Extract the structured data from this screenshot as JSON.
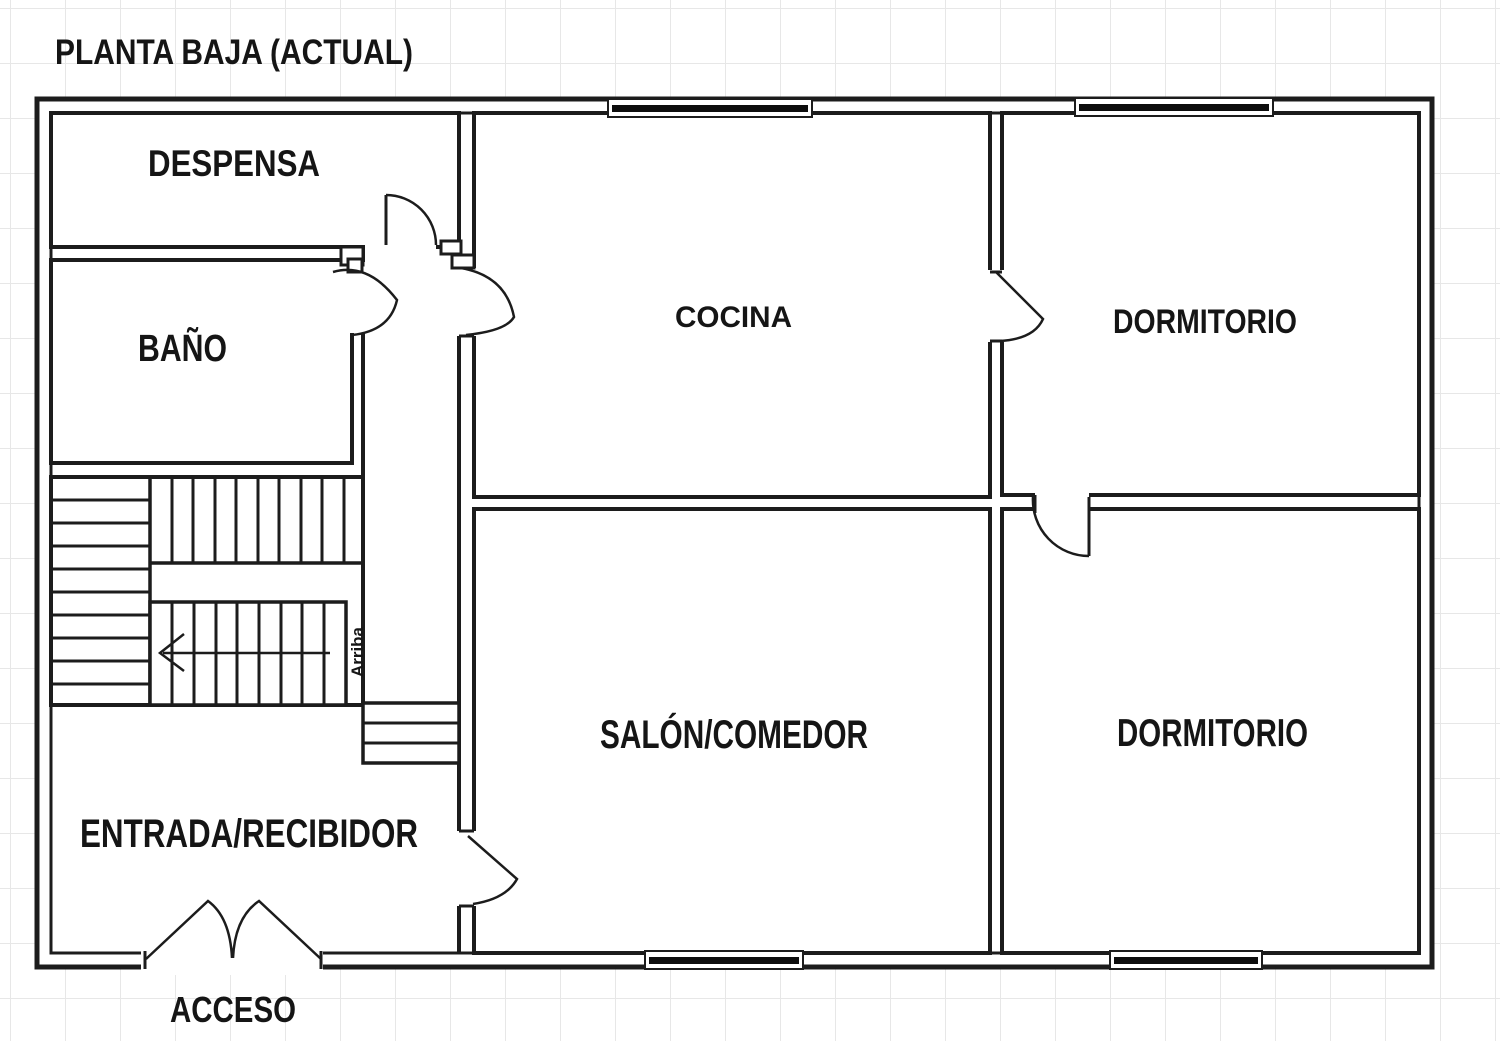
{
  "title": "PLANTA BAJA (ACTUAL)",
  "colors": {
    "wall": "#1c1c1c",
    "grid": "#e7e7e7",
    "window_glass": "#0d0d0d",
    "background": "#ffffff"
  },
  "floor_plan": {
    "rooms": [
      {
        "id": "despensa",
        "label": "DESPENSA"
      },
      {
        "id": "bano",
        "label": "BAÑO"
      },
      {
        "id": "cocina",
        "label": "COCINA"
      },
      {
        "id": "dormitorio_top",
        "label": "DORMITORIO"
      },
      {
        "id": "salon_comedor",
        "label": "SALÓN/COMEDOR"
      },
      {
        "id": "dormitorio_bottom",
        "label": "DORMITORIO"
      },
      {
        "id": "entrada_recibidor",
        "label": "ENTRADA/RECIBIDOR"
      },
      {
        "id": "acceso",
        "label": "ACCESO"
      }
    ],
    "stairs": {
      "up_label": "Arriba"
    },
    "windows": {
      "count": 4
    },
    "doors": {
      "count": 8
    }
  }
}
